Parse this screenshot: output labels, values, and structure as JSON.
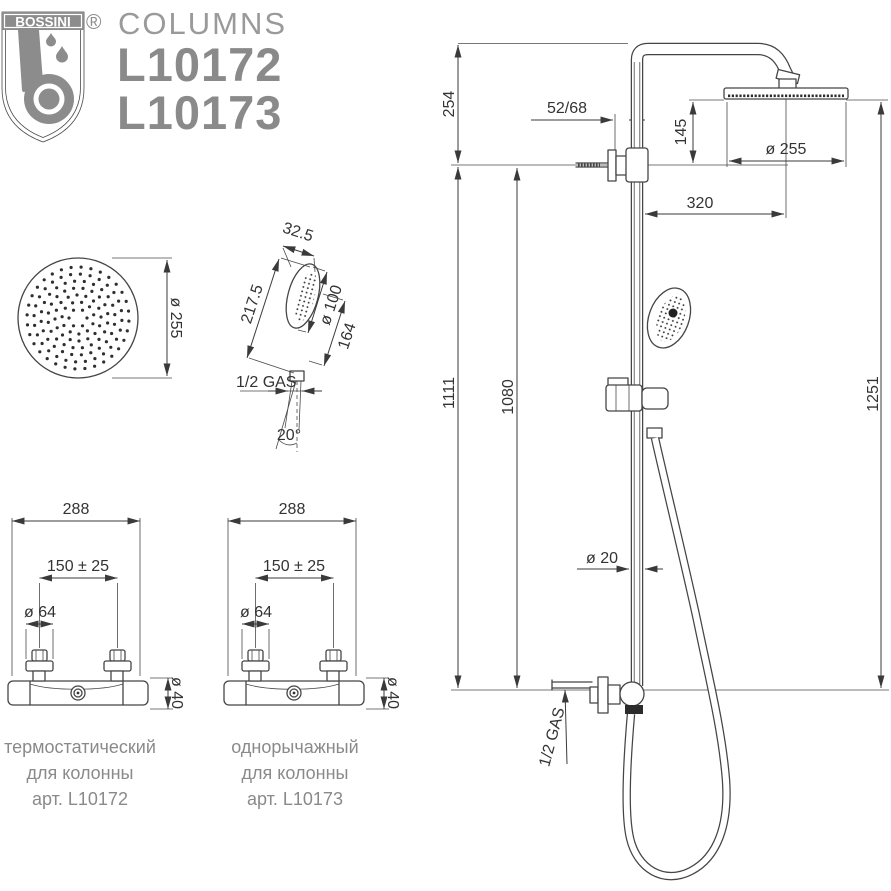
{
  "header": {
    "brand": "BOSSINI",
    "registered": "®",
    "series": "COLUMNS",
    "model_1": "L10172",
    "model_2": "L10173"
  },
  "colors": {
    "line": "#454545",
    "dimension_text": "#333333",
    "brand_gray": "#8a8a8a"
  },
  "top_view": {
    "diameter": "ø 255"
  },
  "hand_shower": {
    "top_width": "32.5",
    "length": "217.5",
    "head_diameter": "ø 100",
    "head_length": "164",
    "thread": "1/2 GAS",
    "spray_angle": "20°"
  },
  "mixers": {
    "shared": {
      "width": "288",
      "interaxis": "150 ± 25",
      "handle_diameter": "ø 64",
      "body_diameter": "ø 40"
    },
    "thermostatic": {
      "caption_1": "термостатический",
      "caption_2": "для колонны",
      "caption_3": "арт. L10172"
    },
    "single_lever": {
      "caption_1": "однорычажный",
      "caption_2": "для колонны",
      "caption_3": "арт. L10173"
    }
  },
  "column_view": {
    "upper_height": "254",
    "wall_offset": "52/68",
    "head_drop": "145",
    "head_diameter": "ø 255",
    "arm_reach": "320",
    "column_height": "1111",
    "inlet_height": "1080",
    "pipe_diameter": "ø 20",
    "overall_height": "1251",
    "thread": "1/2 GAS"
  }
}
